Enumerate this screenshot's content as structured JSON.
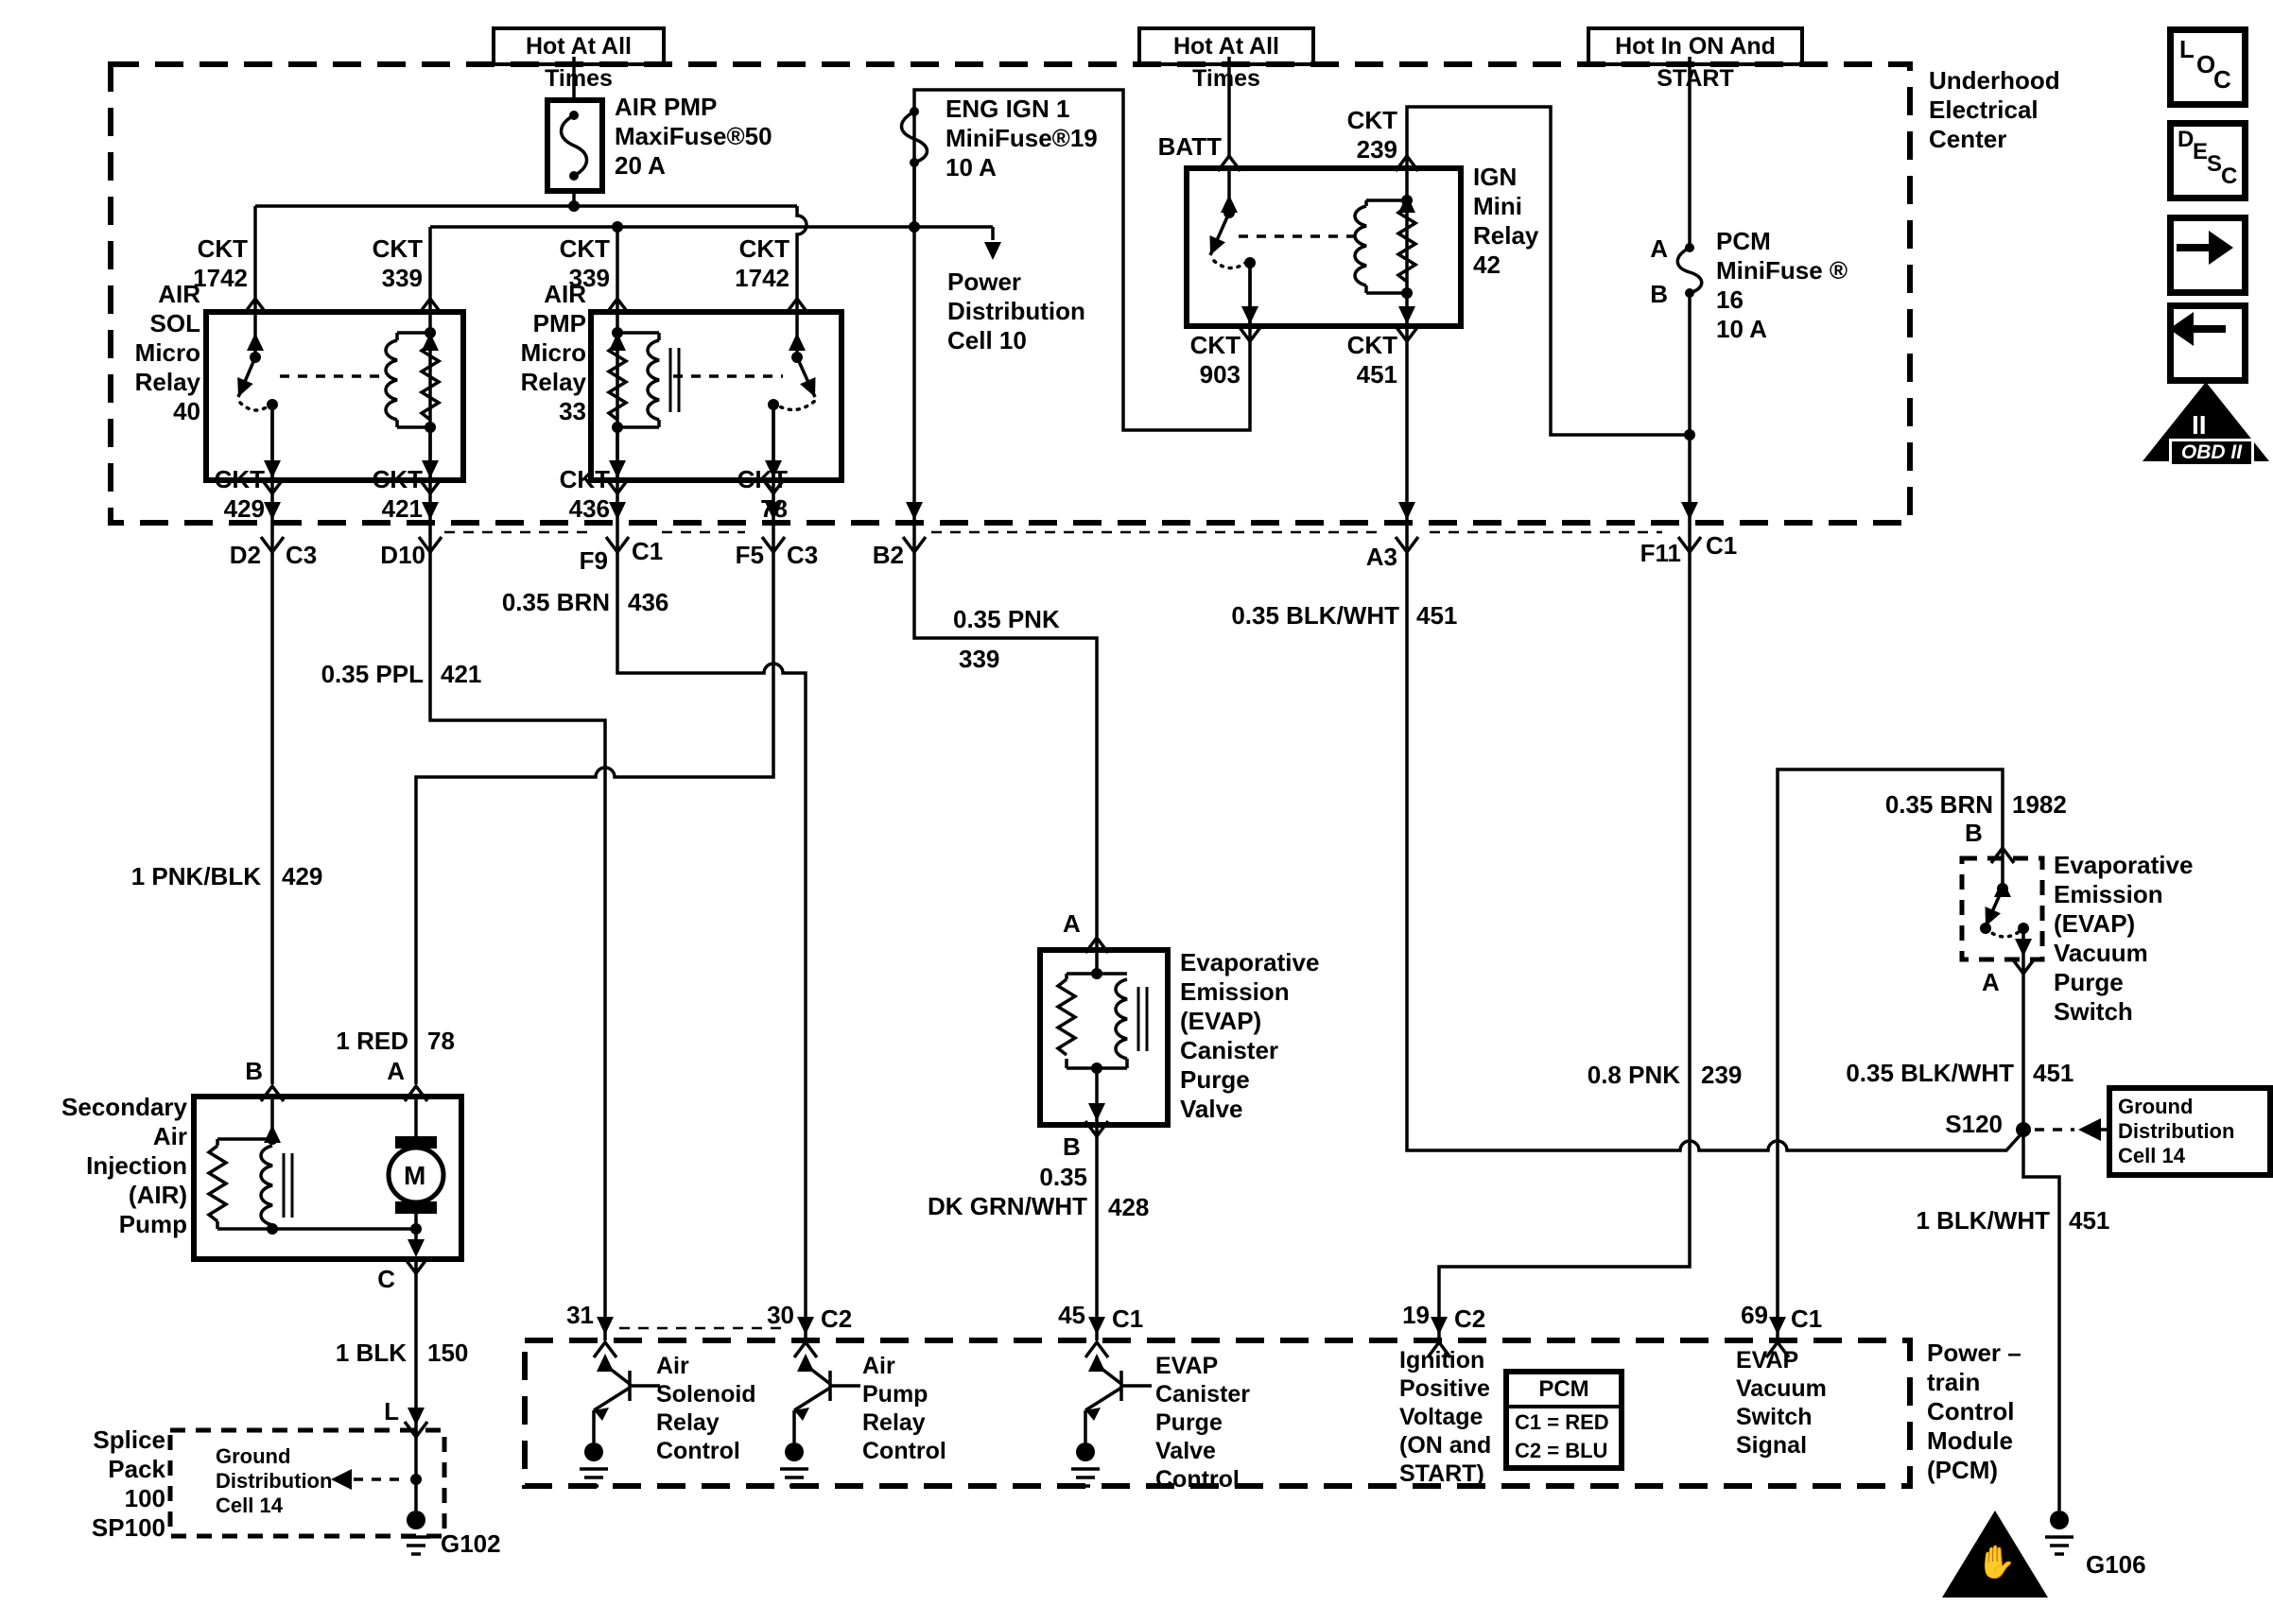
{
  "header": {
    "hot1": "Hot At All Times",
    "hot2": "Hot At All Times",
    "hot3": "Hot In ON And START",
    "underhood": "Underhood\nElectrical\nCenter"
  },
  "fuses": {
    "air_pmp": "AIR PMP\nMaxiFuse®50\n20 A",
    "eng_ign": "ENG IGN 1\nMiniFuse®19\n10 A",
    "pcm": "PCM\nMiniFuse ®\n16\n10 A",
    "pcm_a": "A",
    "pcm_b": "B"
  },
  "refs": {
    "power_dist": "Power\nDistribution\nCell 10",
    "ground_dist_splice": "Ground\nDistribution\nCell 14",
    "ground_dist_s120": "Ground\nDistribution\nCell 14"
  },
  "relays": {
    "air_sol": "AIR\nSOL\nMicro\nRelay\n40",
    "air_pmp": "AIR\nPMP\nMicro\nRelay\n33",
    "ign": "IGN\nMini\nRelay\n42",
    "batt": "BATT"
  },
  "ckt": {
    "t1742": "CKT\n1742",
    "t339": "CKT\n339",
    "t239": "CKT\n239",
    "t903": "CKT\n903",
    "t451": "CKT\n451",
    "t429": "CKT\n429",
    "t421": "CKT\n421",
    "t436": "CKT\n436",
    "t78": "CKT\n78"
  },
  "connectors": {
    "d2": "D2",
    "c3": "C3",
    "d10": "D10",
    "f9": "F9",
    "c1": "C1",
    "f5": "F5",
    "b2": "B2",
    "a3": "A3",
    "f11": "F11"
  },
  "wires": {
    "w429": {
      "name": "1 PNK/BLK",
      "ckt": "429"
    },
    "w421": {
      "name": "0.35 PPL",
      "ckt": "421"
    },
    "w436": {
      "name": "0.35 BRN",
      "ckt": "436"
    },
    "w339": {
      "name": "0.35 PNK",
      "ckt": "339"
    },
    "w451a": {
      "name": "0.35 BLK/WHT",
      "ckt": "451"
    },
    "w78": {
      "name": "1 RED",
      "ckt": "78"
    },
    "w239": {
      "name": "0.8 PNK",
      "ckt": "239"
    },
    "w1982": {
      "name": "0.35 BRN",
      "ckt": "1982"
    },
    "w451b": {
      "name": "0.35 BLK/WHT",
      "ckt": "451"
    },
    "w451c": {
      "name": "1 BLK/WHT",
      "ckt": "451"
    },
    "w150": {
      "name": "1 BLK",
      "ckt": "150"
    },
    "w428": {
      "name": "0.35\nDK GRN/WHT",
      "ckt": "428"
    }
  },
  "components": {
    "air_pump": {
      "label": "Secondary\nAir\nInjection\n(AIR)\nPump",
      "term_b": "B",
      "term_a": "A",
      "term_c": "C",
      "term_l": "L",
      "motor": "M"
    },
    "purge_valve": {
      "term_a": "A",
      "term_b": "B",
      "label": "Evaporative\nEmission\n(EVAP)\nCanister\nPurge\nValve"
    },
    "vac_switch": {
      "term_b": "B",
      "term_a": "A",
      "label": "Evaporative\nEmission\n(EVAP)\nVacuum\nPurge\nSwitch"
    },
    "splice_pack": {
      "label": "Splice\nPack\n100\nSP100"
    },
    "s120": "S120",
    "g102": "G102",
    "g106": "G106"
  },
  "pcm": {
    "title": "Power –\ntrain\nControl\nModule\n(PCM)",
    "legend": {
      "title": "PCM",
      "c1": "C1 = RED",
      "c2": "C2 = BLU"
    },
    "pins": {
      "p31": "31",
      "p30": "30",
      "p30c": "C2",
      "p45": "45",
      "p45c": "C1",
      "p19": "19",
      "p19c": "C2",
      "p69": "69",
      "p69c": "C1"
    },
    "fn31": "Air\nSolenoid\nRelay\nControl",
    "fn30": "Air\nPump\nRelay\nControl",
    "fn45": "EVAP\nCanister\nPurge\nValve\nControl",
    "fn19": "Ignition\nPositive\nVoltage\n(ON and\nSTART)",
    "fn69": "EVAP\nVacuum\nSwitch\nSignal"
  },
  "icons": {
    "loc": {
      "l": "L",
      "o": "O",
      "c": "C"
    },
    "desc": {
      "d": "D",
      "e": "E",
      "s": "S",
      "c": "C"
    },
    "obd": {
      "numeral": "II",
      "label": "OBD II"
    },
    "esd_hand": "✋"
  }
}
